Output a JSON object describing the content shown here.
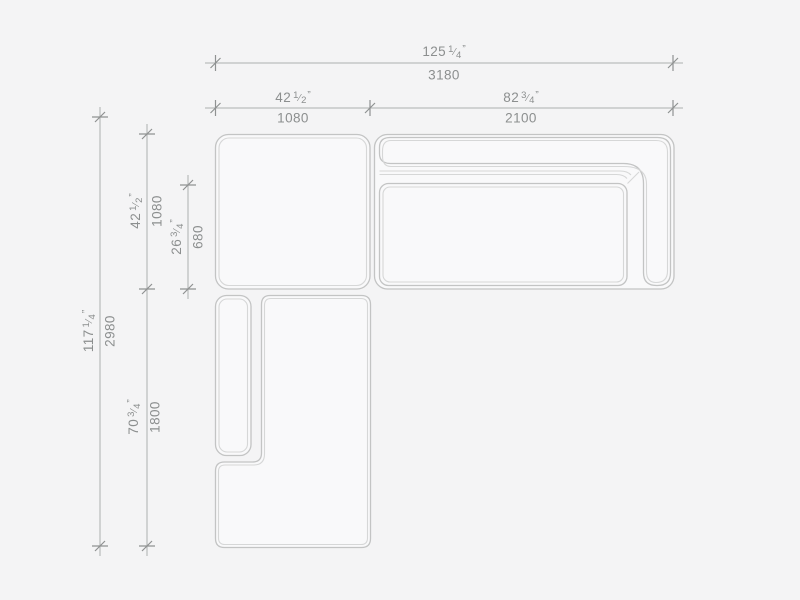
{
  "drawing": {
    "type": "furniture-dimension-diagram",
    "subject": "sectional-sofa-top-view",
    "modules": [
      "corner-module",
      "sofa-module-with-back-and-right-arm",
      "chaise-module-with-left-armrest"
    ]
  },
  "punctuation": {
    "fraction_slash": "⁄",
    "unit_mark": "”"
  },
  "colors": {
    "background": "#f4f4f5",
    "module_fill": "#f9f9fa",
    "outline": "#c3c4c4",
    "inner_line": "#d6d7d7",
    "dim_line": "#adafaf",
    "tick": "#8f9292",
    "label_text": "#8c8f8f"
  },
  "dimensions": [
    {
      "id": "overall-width",
      "inches_whole": "125",
      "frac_num": "1",
      "frac_den": "4",
      "mm": "3180",
      "orientation": "horizontal"
    },
    {
      "id": "corner-module-width",
      "inches_whole": "42",
      "frac_num": "1",
      "frac_den": "2",
      "mm": "1080",
      "orientation": "horizontal"
    },
    {
      "id": "sofa-module-width",
      "inches_whole": "82",
      "frac_num": "3",
      "frac_den": "4",
      "mm": "2100",
      "orientation": "horizontal"
    },
    {
      "id": "overall-depth",
      "inches_whole": "117",
      "frac_num": "1",
      "frac_den": "4",
      "mm": "2980",
      "orientation": "vertical"
    },
    {
      "id": "corner-module-depth",
      "inches_whole": "42",
      "frac_num": "1",
      "frac_den": "2",
      "mm": "1080",
      "orientation": "vertical"
    },
    {
      "id": "seat-depth",
      "inches_whole": "26",
      "frac_num": "3",
      "frac_den": "4",
      "mm": "680",
      "orientation": "vertical"
    },
    {
      "id": "chaise-length",
      "inches_whole": "70",
      "frac_num": "3",
      "frac_den": "4",
      "mm": "1800",
      "orientation": "vertical"
    }
  ]
}
